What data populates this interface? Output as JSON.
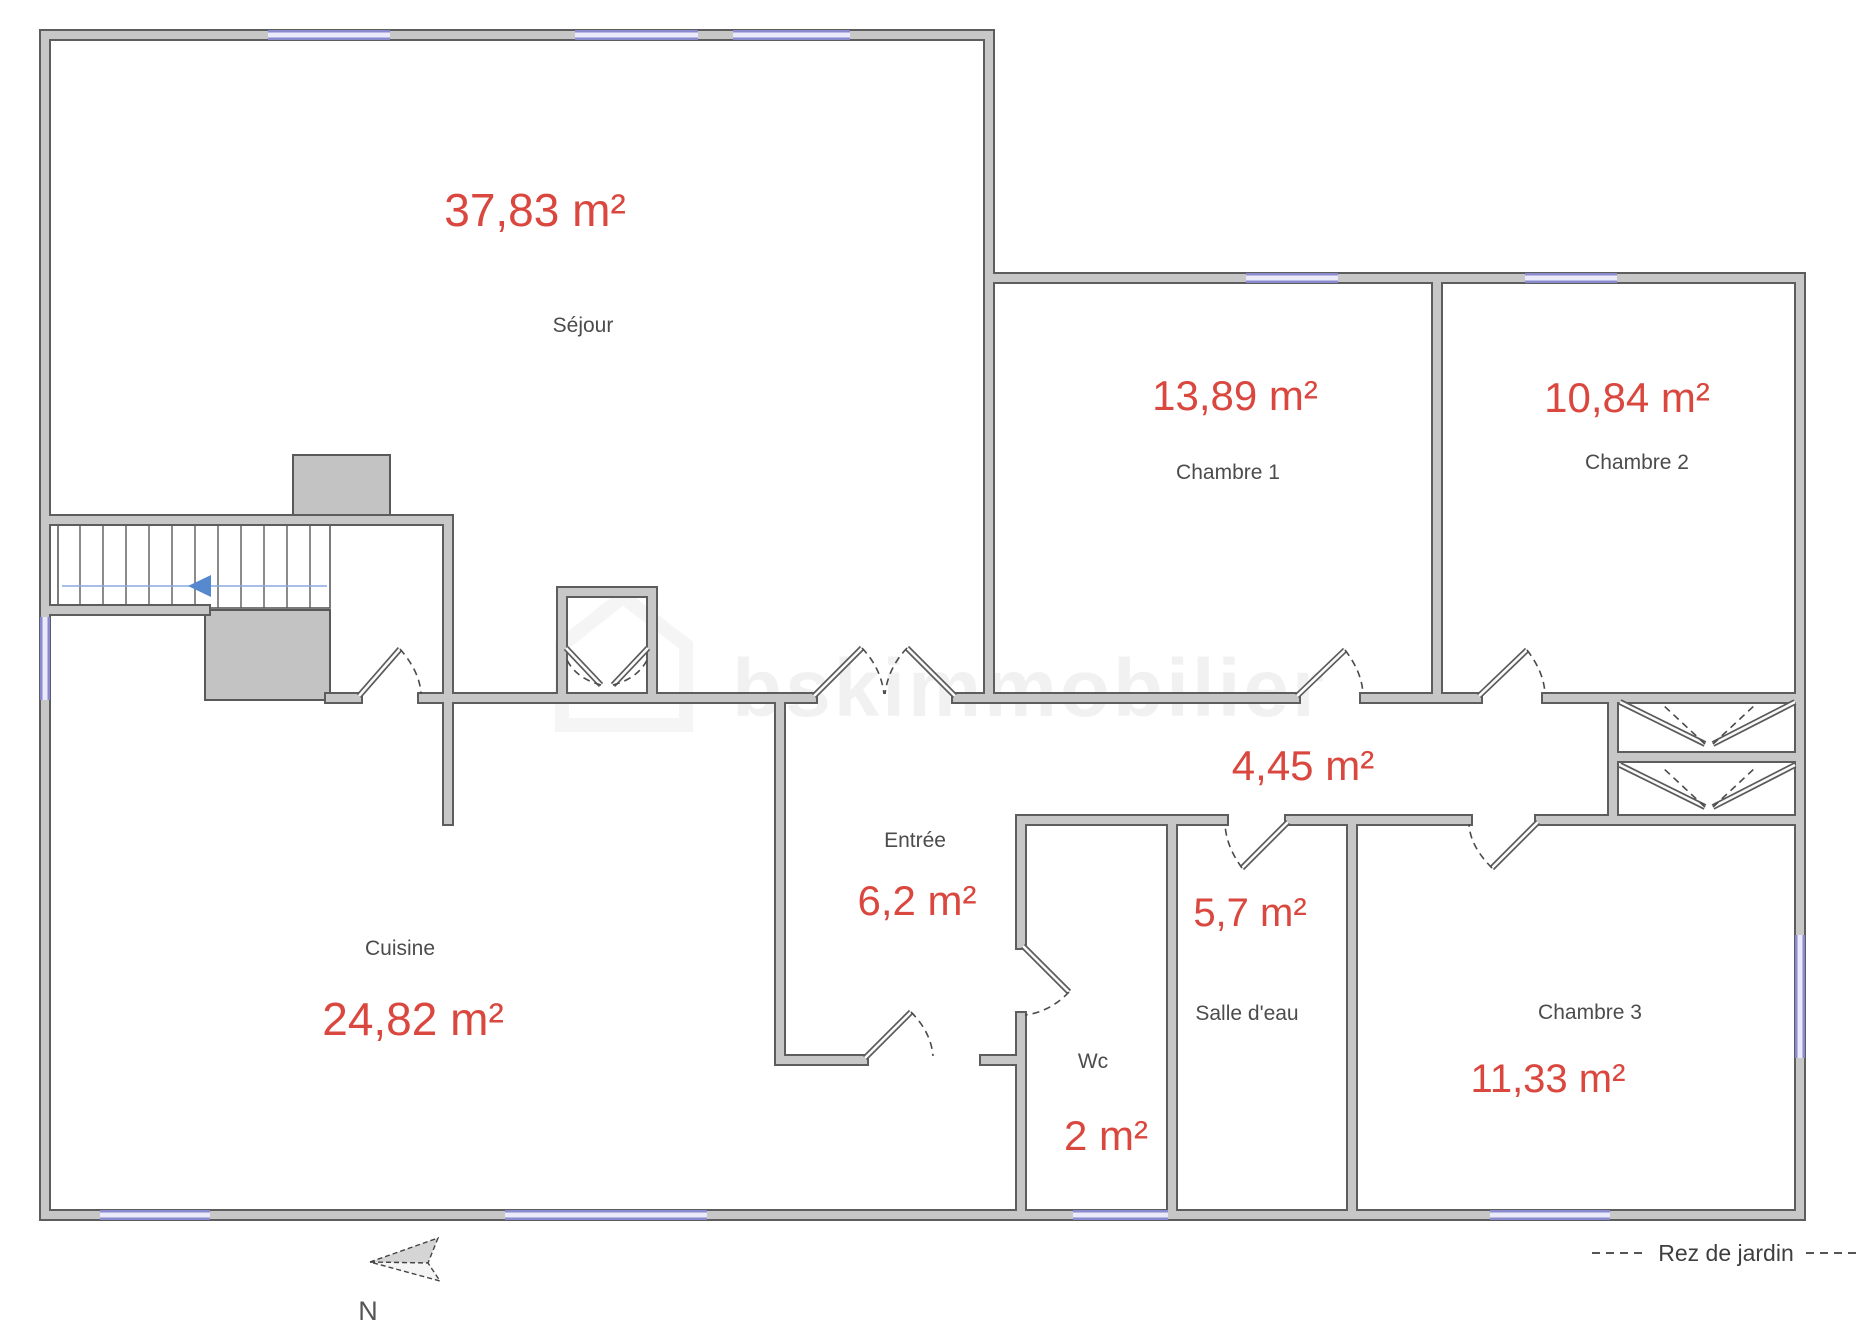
{
  "watermark": {
    "text": "bskimmobilier"
  },
  "legend": {
    "floor_label": "Rez de jardin"
  },
  "compass": {
    "north_label": "N"
  },
  "colors": {
    "area_accent": "#d9473f",
    "room_label": "#4c4c4c",
    "wall_edge": "#5d5d5d",
    "wall_fill": "#c7c7c7",
    "window": "#8a8ace",
    "stair_arrow": "#5588cc"
  },
  "rooms": [
    {
      "id": "sejour",
      "name": "Séjour",
      "area": "37,83 m²"
    },
    {
      "id": "chambre-1",
      "name": "Chambre 1",
      "area": "13,89 m²"
    },
    {
      "id": "chambre-2",
      "name": "Chambre 2",
      "area": "10,84 m²"
    },
    {
      "id": "degagement",
      "name": "",
      "area": "4,45 m²"
    },
    {
      "id": "entree",
      "name": "Entrée",
      "area": "6,2 m²"
    },
    {
      "id": "salle-d-eau",
      "name": "Salle d'eau",
      "area": "5,7 m²"
    },
    {
      "id": "wc",
      "name": "Wc",
      "area": "2 m²"
    },
    {
      "id": "chambre-3",
      "name": "Chambre 3",
      "area": "11,33 m²"
    },
    {
      "id": "cuisine",
      "name": "Cuisine",
      "area": "24,82 m²"
    }
  ]
}
